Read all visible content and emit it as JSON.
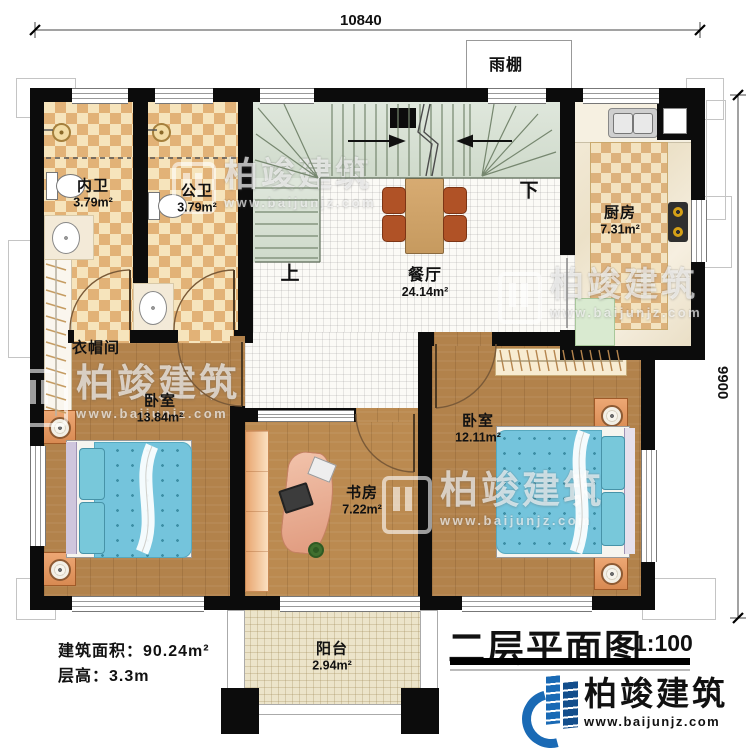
{
  "plan": {
    "title": "二层平面图",
    "scale": "1:100",
    "notes": {
      "area": "建筑面积：90.24m²",
      "floor_height": "层高：3.3m"
    }
  },
  "dimensions": {
    "width_mm": "10840",
    "depth_mm": "9900"
  },
  "rooms": {
    "bath_inner": {
      "name": "内卫",
      "area": "3.79m²"
    },
    "bath_public": {
      "name": "公卫",
      "area": "3.79m²"
    },
    "kitchen": {
      "name": "厨房",
      "area": "7.31m²"
    },
    "dining": {
      "name": "餐厅",
      "area": "24.14m²"
    },
    "cloakroom": {
      "name": "衣帽间"
    },
    "bedroom_left": {
      "name": "卧室",
      "area": "13.84m²"
    },
    "bedroom_right": {
      "name": "卧室",
      "area": "12.11m²"
    },
    "study": {
      "name": "书房",
      "area": "7.22m²"
    },
    "balcony": {
      "name": "阳台",
      "area": "2.94m²"
    },
    "canopy": {
      "name": "雨棚"
    }
  },
  "stairs": {
    "up_label": "上",
    "down_label": "下"
  },
  "branding": {
    "name": "柏竣建筑",
    "website": "www.baijunjz.com",
    "brand_blue": "#1a6ab5"
  },
  "colors": {
    "wall": "#0c0c0c",
    "stair_green": "#d7e0d4",
    "tile_tan": "#e2b277",
    "wood": "#b2824b",
    "bed_blue": "#74c4dc"
  }
}
